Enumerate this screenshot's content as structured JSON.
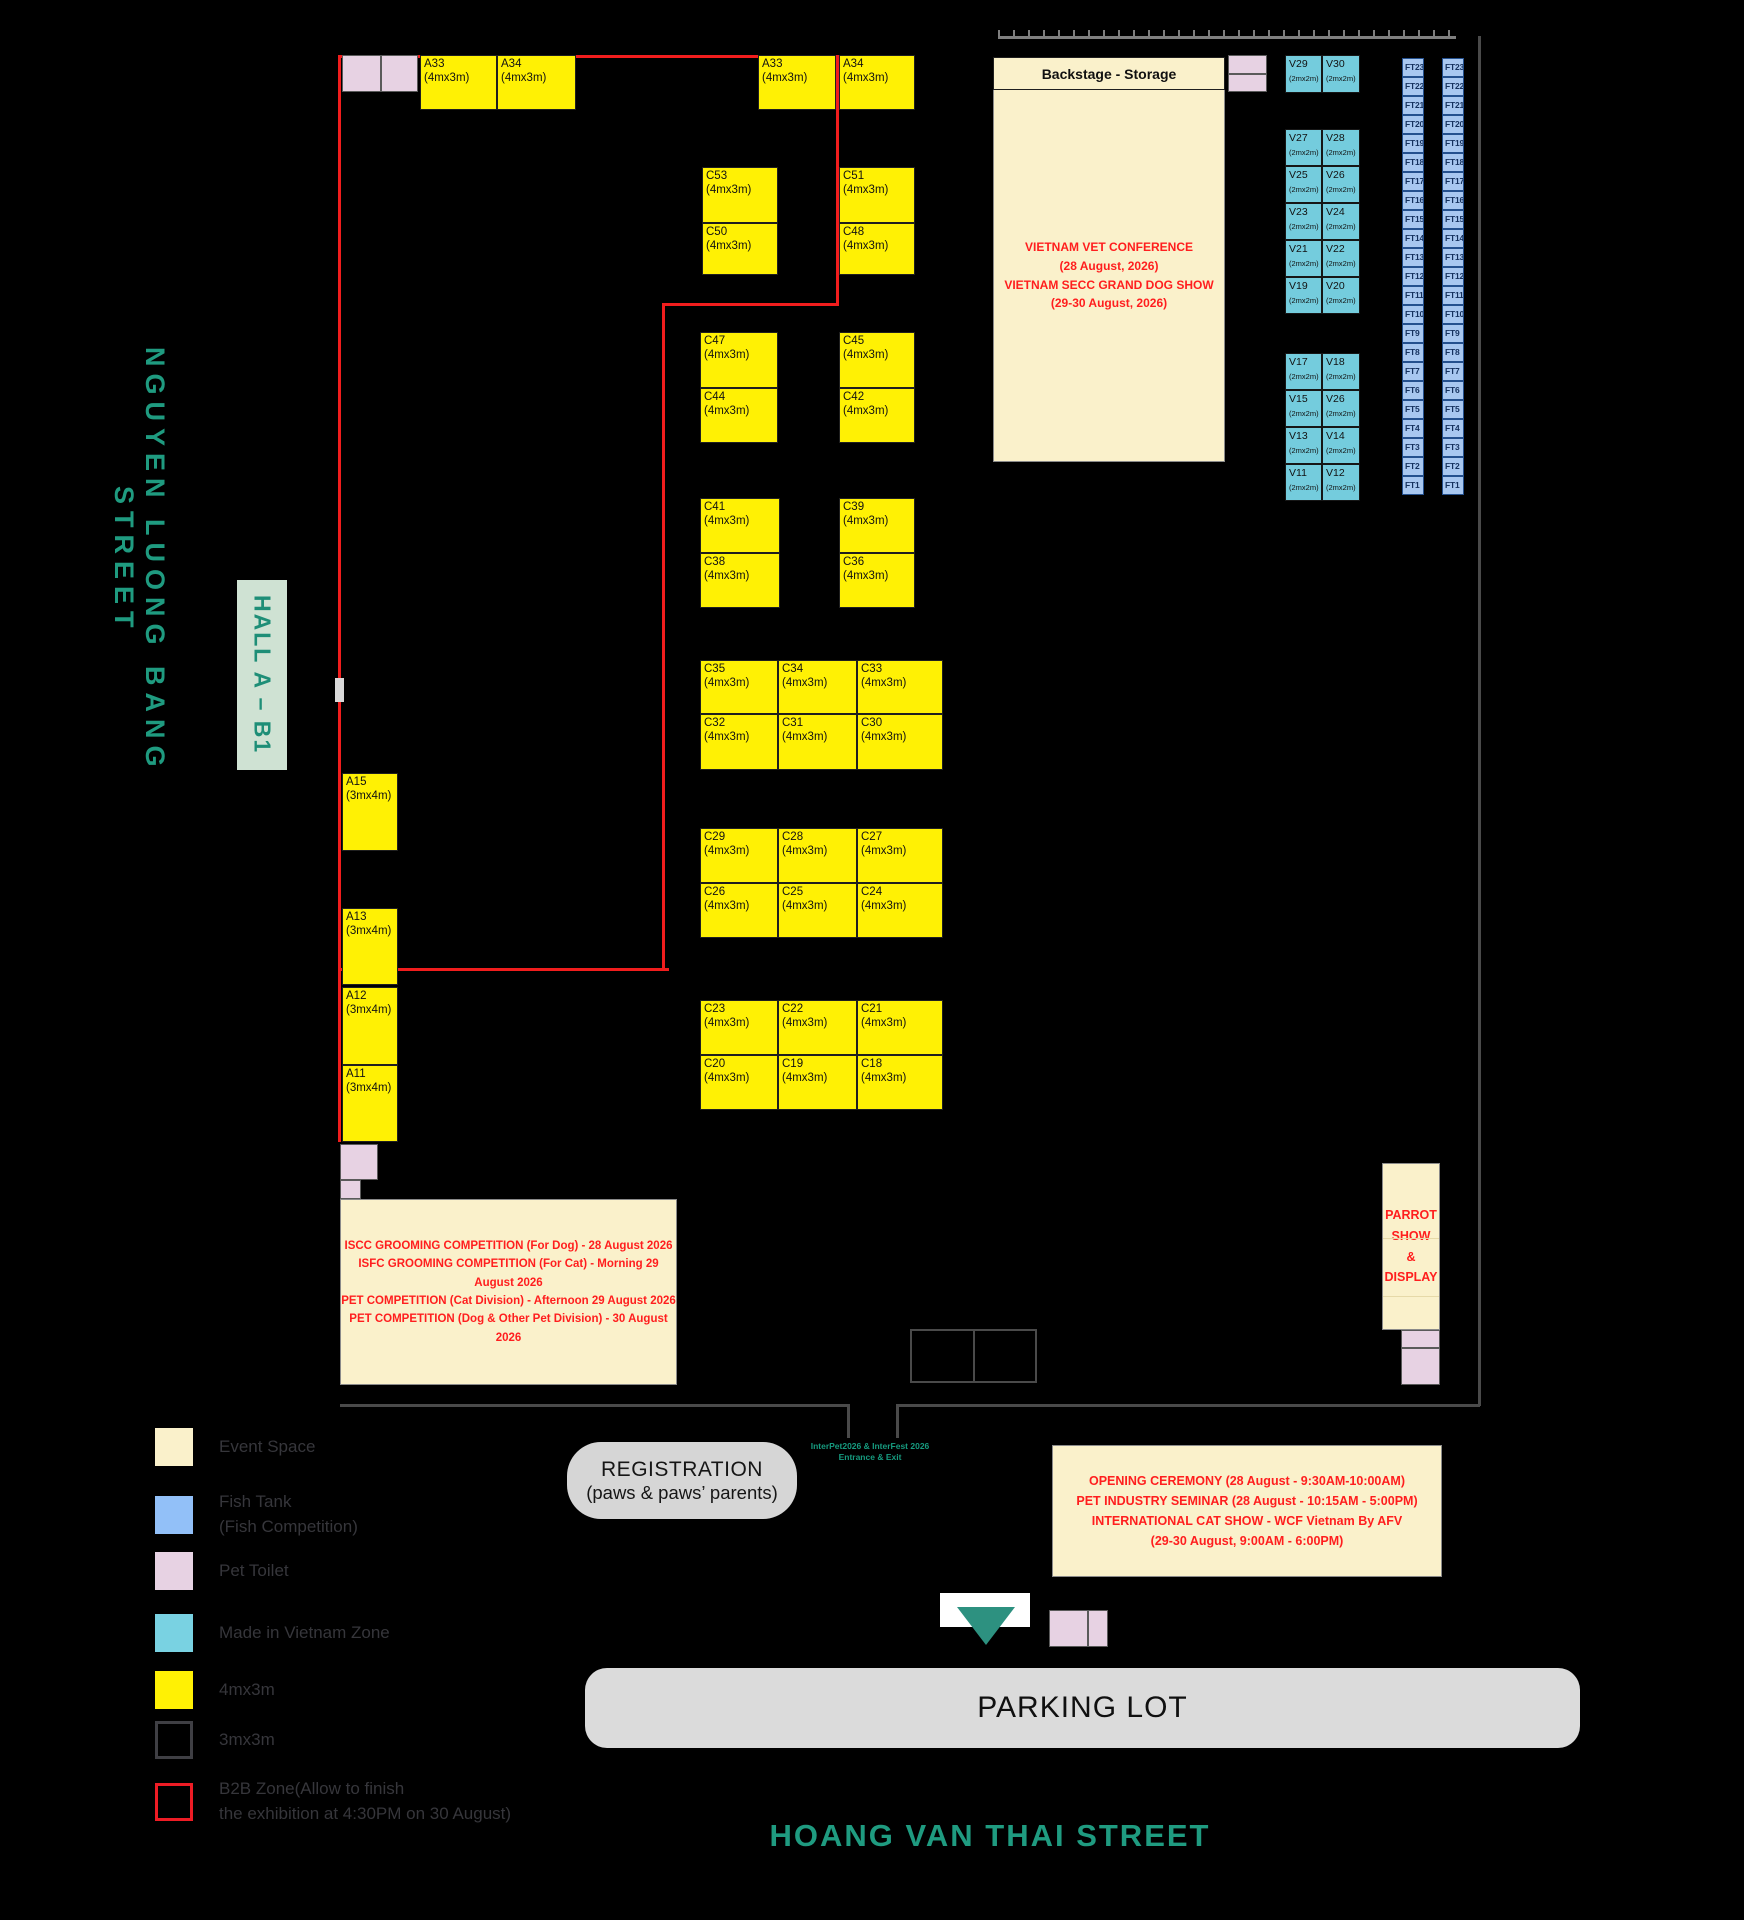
{
  "streets": {
    "left": "NGUYEN LUONG BANG STREET",
    "bottom": "HOANG VAN THAI STREET"
  },
  "hall_label": "HALL A – B1",
  "backstage": {
    "title": "Backstage - Storage",
    "conference": "VIETNAM VET CONFERENCE\n(28 August, 2026)\nVIETNAM SECC GRAND DOG SHOW\n(29-30 August, 2026)"
  },
  "events": {
    "iscc": "ISCC GROOMING COMPETITION (For Dog) - 28 August 2026\nISFC GROOMING COMPETITION (For Cat) - Morning 29 August 2026\nPET COMPETITION (Cat Division) - Afternoon 29 August 2026\nPET COMPETITION (Dog & Other Pet Division) - 30 August 2026",
    "parrot": "PARROT\nSHOW\n&\nDISPLAY",
    "opening": "OPENING CEREMONY (28 August - 9:30AM-10:00AM)\nPET INDUSTRY SEMINAR  (28 August - 10:15AM - 5:00PM)\nINTERNATIONAL CAT SHOW - WCF Vietnam By AFV\n(29-30 August, 9:00AM - 6:00PM)"
  },
  "registration": {
    "line1": "REGISTRATION",
    "line2": "(paws & paws’ parents)"
  },
  "entrance": {
    "text": "InterPet2026 & InterFest 2026\nEntrance & Exit"
  },
  "parking_label": "PARKING LOT",
  "colors": {
    "accent_teal_text": "#1F9B80",
    "booth_yellow": "#FFF104",
    "booth_teal": "#74CCDD",
    "fish_tank_blue": "#A8C7F0",
    "pet_toilet_pink": "#E7D2E3",
    "event_cream": "#FAF1CB",
    "b2b_red": "#F11D1D",
    "red_text": "#FF1E1E"
  },
  "map": {
    "booths": [
      {
        "id": "A33",
        "dim": "(4mx3m)",
        "type": "y",
        "x": 420,
        "y": 55,
        "w": 77,
        "h": 55
      },
      {
        "id": "A34",
        "dim": "(4mx3m)",
        "type": "y",
        "x": 497,
        "y": 55,
        "w": 79,
        "h": 55
      },
      {
        "id": "A33",
        "dim": "(4mx3m)",
        "type": "y",
        "x": 758,
        "y": 55,
        "w": 78,
        "h": 55
      },
      {
        "id": "A34",
        "dim": "(4mx3m)",
        "type": "y",
        "x": 839,
        "y": 55,
        "w": 76,
        "h": 55
      },
      {
        "id": "C53",
        "dim": "(4mx3m)",
        "type": "y",
        "x": 702,
        "y": 167,
        "w": 76,
        "h": 56
      },
      {
        "id": "C50",
        "dim": "(4mx3m)",
        "type": "y",
        "x": 702,
        "y": 223,
        "w": 76,
        "h": 52
      },
      {
        "id": "C51",
        "dim": "(4mx3m)",
        "type": "y",
        "x": 839,
        "y": 167,
        "w": 76,
        "h": 56
      },
      {
        "id": "C48",
        "dim": "(4mx3m)",
        "type": "y",
        "x": 839,
        "y": 223,
        "w": 76,
        "h": 52
      },
      {
        "id": "C47",
        "dim": "(4mx3m)",
        "type": "y",
        "x": 700,
        "y": 332,
        "w": 78,
        "h": 56
      },
      {
        "id": "C44",
        "dim": "(4mx3m)",
        "type": "y",
        "x": 700,
        "y": 388,
        "w": 78,
        "h": 55
      },
      {
        "id": "C45",
        "dim": "(4mx3m)",
        "type": "y",
        "x": 839,
        "y": 332,
        "w": 76,
        "h": 56
      },
      {
        "id": "C42",
        "dim": "(4mx3m)",
        "type": "y",
        "x": 839,
        "y": 388,
        "w": 76,
        "h": 55
      },
      {
        "id": "C41",
        "dim": "(4mx3m)",
        "type": "y",
        "x": 700,
        "y": 498,
        "w": 80,
        "h": 55
      },
      {
        "id": "C38",
        "dim": "(4mx3m)",
        "type": "y",
        "x": 700,
        "y": 553,
        "w": 80,
        "h": 55
      },
      {
        "id": "C39",
        "dim": "(4mx3m)",
        "type": "y",
        "x": 839,
        "y": 498,
        "w": 76,
        "h": 55
      },
      {
        "id": "C36",
        "dim": "(4mx3m)",
        "type": "y",
        "x": 839,
        "y": 553,
        "w": 76,
        "h": 55
      },
      {
        "id": "C35",
        "dim": "(4mx3m)",
        "type": "y",
        "x": 700,
        "y": 660,
        "w": 78,
        "h": 54
      },
      {
        "id": "C34",
        "dim": "(4mx3m)",
        "type": "y",
        "x": 778,
        "y": 660,
        "w": 79,
        "h": 54
      },
      {
        "id": "C33",
        "dim": "(4mx3m)",
        "type": "y",
        "x": 857,
        "y": 660,
        "w": 86,
        "h": 54
      },
      {
        "id": "C32",
        "dim": "(4mx3m)",
        "type": "y",
        "x": 700,
        "y": 714,
        "w": 78,
        "h": 56
      },
      {
        "id": "C31",
        "dim": "(4mx3m)",
        "type": "y",
        "x": 778,
        "y": 714,
        "w": 79,
        "h": 56
      },
      {
        "id": "C30",
        "dim": "(4mx3m)",
        "type": "y",
        "x": 857,
        "y": 714,
        "w": 86,
        "h": 56
      },
      {
        "id": "C29",
        "dim": "(4mx3m)",
        "type": "y",
        "x": 700,
        "y": 828,
        "w": 78,
        "h": 55
      },
      {
        "id": "C28",
        "dim": "(4mx3m)",
        "type": "y",
        "x": 778,
        "y": 828,
        "w": 79,
        "h": 55
      },
      {
        "id": "C27",
        "dim": "(4mx3m)",
        "type": "y",
        "x": 857,
        "y": 828,
        "w": 86,
        "h": 55
      },
      {
        "id": "C26",
        "dim": "(4mx3m)",
        "type": "y",
        "x": 700,
        "y": 883,
        "w": 78,
        "h": 55
      },
      {
        "id": "C25",
        "dim": "(4mx3m)",
        "type": "y",
        "x": 778,
        "y": 883,
        "w": 79,
        "h": 55
      },
      {
        "id": "C24",
        "dim": "(4mx3m)",
        "type": "y",
        "x": 857,
        "y": 883,
        "w": 86,
        "h": 55
      },
      {
        "id": "C23",
        "dim": "(4mx3m)",
        "type": "y",
        "x": 700,
        "y": 1000,
        "w": 78,
        "h": 55
      },
      {
        "id": "C22",
        "dim": "(4mx3m)",
        "type": "y",
        "x": 778,
        "y": 1000,
        "w": 79,
        "h": 55
      },
      {
        "id": "C21",
        "dim": "(4mx3m)",
        "type": "y",
        "x": 857,
        "y": 1000,
        "w": 86,
        "h": 55
      },
      {
        "id": "C20",
        "dim": "(4mx3m)",
        "type": "y",
        "x": 700,
        "y": 1055,
        "w": 78,
        "h": 55
      },
      {
        "id": "C19",
        "dim": "(4mx3m)",
        "type": "y",
        "x": 778,
        "y": 1055,
        "w": 79,
        "h": 55
      },
      {
        "id": "C18",
        "dim": "(4mx3m)",
        "type": "y",
        "x": 857,
        "y": 1055,
        "w": 86,
        "h": 55
      },
      {
        "id": "A15",
        "dim": "(3mx4m)",
        "type": "y",
        "x": 342,
        "y": 773,
        "w": 56,
        "h": 78
      },
      {
        "id": "A13",
        "dim": "(3mx4m)",
        "type": "y",
        "x": 342,
        "y": 908,
        "w": 56,
        "h": 77
      },
      {
        "id": "A12",
        "dim": "(3mx4m)",
        "type": "y",
        "x": 342,
        "y": 987,
        "w": 56,
        "h": 78
      },
      {
        "id": "A11",
        "dim": "(3mx4m)",
        "type": "y",
        "x": 342,
        "y": 1065,
        "w": 56,
        "h": 77
      },
      {
        "id": "V29",
        "dim": "(2mx2m)",
        "type": "v",
        "x": 1285,
        "y": 55,
        "w": 37,
        "h": 38
      },
      {
        "id": "V30",
        "dim": "(2mx2m)",
        "type": "v",
        "x": 1322,
        "y": 55,
        "w": 38,
        "h": 38
      },
      {
        "id": "V27",
        "dim": "(2mx2m)",
        "type": "v",
        "x": 1285,
        "y": 129,
        "w": 37,
        "h": 37
      },
      {
        "id": "V28",
        "dim": "(2mx2m)",
        "type": "v",
        "x": 1322,
        "y": 129,
        "w": 38,
        "h": 37
      },
      {
        "id": "V25",
        "dim": "(2mx2m)",
        "type": "v",
        "x": 1285,
        "y": 166,
        "w": 37,
        "h": 37
      },
      {
        "id": "V26",
        "dim": "(2mx2m)",
        "type": "v",
        "x": 1322,
        "y": 166,
        "w": 38,
        "h": 37
      },
      {
        "id": "V23",
        "dim": "(2mx2m)",
        "type": "v",
        "x": 1285,
        "y": 203,
        "w": 37,
        "h": 37
      },
      {
        "id": "V24",
        "dim": "(2mx2m)",
        "type": "v",
        "x": 1322,
        "y": 203,
        "w": 38,
        "h": 37
      },
      {
        "id": "V21",
        "dim": "(2mx2m)",
        "type": "v",
        "x": 1285,
        "y": 240,
        "w": 37,
        "h": 37
      },
      {
        "id": "V22",
        "dim": "(2mx2m)",
        "type": "v",
        "x": 1322,
        "y": 240,
        "w": 38,
        "h": 37
      },
      {
        "id": "V19",
        "dim": "(2mx2m)",
        "type": "v",
        "x": 1285,
        "y": 277,
        "w": 37,
        "h": 37
      },
      {
        "id": "V20",
        "dim": "(2mx2m)",
        "type": "v",
        "x": 1322,
        "y": 277,
        "w": 38,
        "h": 37
      },
      {
        "id": "V17",
        "dim": "(2mx2m)",
        "type": "v",
        "x": 1285,
        "y": 353,
        "w": 37,
        "h": 37
      },
      {
        "id": "V18",
        "dim": "(2mx2m)",
        "type": "v",
        "x": 1322,
        "y": 353,
        "w": 38,
        "h": 37
      },
      {
        "id": "V15",
        "dim": "(2mx2m)",
        "type": "v",
        "x": 1285,
        "y": 390,
        "w": 37,
        "h": 37
      },
      {
        "id": "V26",
        "dim": "(2mx2m)",
        "type": "v",
        "x": 1322,
        "y": 390,
        "w": 38,
        "h": 37
      },
      {
        "id": "V13",
        "dim": "(2mx2m)",
        "type": "v",
        "x": 1285,
        "y": 427,
        "w": 37,
        "h": 37
      },
      {
        "id": "V14",
        "dim": "(2mx2m)",
        "type": "v",
        "x": 1322,
        "y": 427,
        "w": 38,
        "h": 37
      },
      {
        "id": "V11",
        "dim": "(2mx2m)",
        "type": "v",
        "x": 1285,
        "y": 464,
        "w": 37,
        "h": 37
      },
      {
        "id": "V12",
        "dim": "(2mx2m)",
        "type": "v",
        "x": 1322,
        "y": 464,
        "w": 38,
        "h": 37
      }
    ],
    "pet_toilets": [
      {
        "x": 342,
        "y": 55,
        "w": 39,
        "h": 37
      },
      {
        "x": 381,
        "y": 55,
        "w": 37,
        "h": 37
      },
      {
        "x": 1228,
        "y": 55,
        "w": 39,
        "h": 19
      },
      {
        "x": 1228,
        "y": 74,
        "w": 39,
        "h": 18
      },
      {
        "x": 340,
        "y": 1144,
        "w": 38,
        "h": 36
      },
      {
        "x": 340,
        "y": 1180,
        "w": 21,
        "h": 19
      },
      {
        "x": 1401,
        "y": 1330,
        "w": 39,
        "h": 18
      },
      {
        "x": 1401,
        "y": 1348,
        "w": 39,
        "h": 37
      },
      {
        "x": 1049,
        "y": 1610,
        "w": 39,
        "h": 37
      },
      {
        "x": 1088,
        "y": 1610,
        "w": 20,
        "h": 37
      }
    ],
    "fish_tanks": {
      "labels": [
        "FT23",
        "FT22",
        "FT21",
        "FT20",
        "FT19",
        "FT18",
        "FT17",
        "FT16",
        "FT15",
        "FT14",
        "FT13",
        "FT12",
        "FT11",
        "FT10",
        "FT9",
        "FT8",
        "FT7",
        "FT6",
        "FT5",
        "FT4",
        "FT3",
        "FT2",
        "FT1"
      ],
      "columns_x": [
        1402,
        1442
      ],
      "y0": 58,
      "cell_w": 22,
      "cell_h": 19
    },
    "b2b_zone": {
      "segments": [
        {
          "x": 338,
          "y": 55,
          "w": 3,
          "h": 1087
        },
        {
          "x": 338,
          "y": 55,
          "w": 501,
          "h": 3
        },
        {
          "x": 836,
          "y": 55,
          "w": 3,
          "h": 250
        },
        {
          "x": 662,
          "y": 303,
          "w": 177,
          "h": 3
        },
        {
          "x": 662,
          "y": 303,
          "w": 3,
          "h": 668
        },
        {
          "x": 338,
          "y": 968,
          "w": 331,
          "h": 3
        }
      ]
    },
    "walls": [
      {
        "x": 340,
        "y": 1404,
        "w": 509,
        "h": 3
      },
      {
        "x": 898,
        "y": 1404,
        "w": 582,
        "h": 3
      },
      {
        "x": 1478,
        "y": 36,
        "w": 3,
        "h": 1370
      },
      {
        "x": 847,
        "y": 1404,
        "w": 3,
        "h": 34
      },
      {
        "x": 896,
        "y": 1404,
        "w": 3,
        "h": 34
      }
    ]
  },
  "legend": {
    "items": [
      {
        "label": "Event Space",
        "swatch": "#FAF1CB",
        "border": "#FAF1CB",
        "y": 1428
      },
      {
        "label": "Fish Tank\n(Fish Competition)",
        "swatch": "#92C0F8",
        "border": "#92C0F8",
        "y": 1490
      },
      {
        "label": "Pet Toilet",
        "swatch": "#E7D2E3",
        "border": "#E7D2E3",
        "y": 1552
      },
      {
        "label": "Made in Vietnam Zone",
        "swatch": "#79D2E2",
        "border": "#79D2E2",
        "y": 1614
      },
      {
        "label": "4mx3m",
        "swatch": "#FFF104",
        "border": "#FFF104",
        "y": 1671
      },
      {
        "label": "3mx3m",
        "swatch": "#000000",
        "border": "#3f3f44",
        "y": 1721
      },
      {
        "label": "B2B Zone(Allow to finish\nthe exhibition at 4:30PM on 30 August)",
        "swatch": "#000000",
        "border": "#EE1C25",
        "y": 1777
      }
    ]
  }
}
